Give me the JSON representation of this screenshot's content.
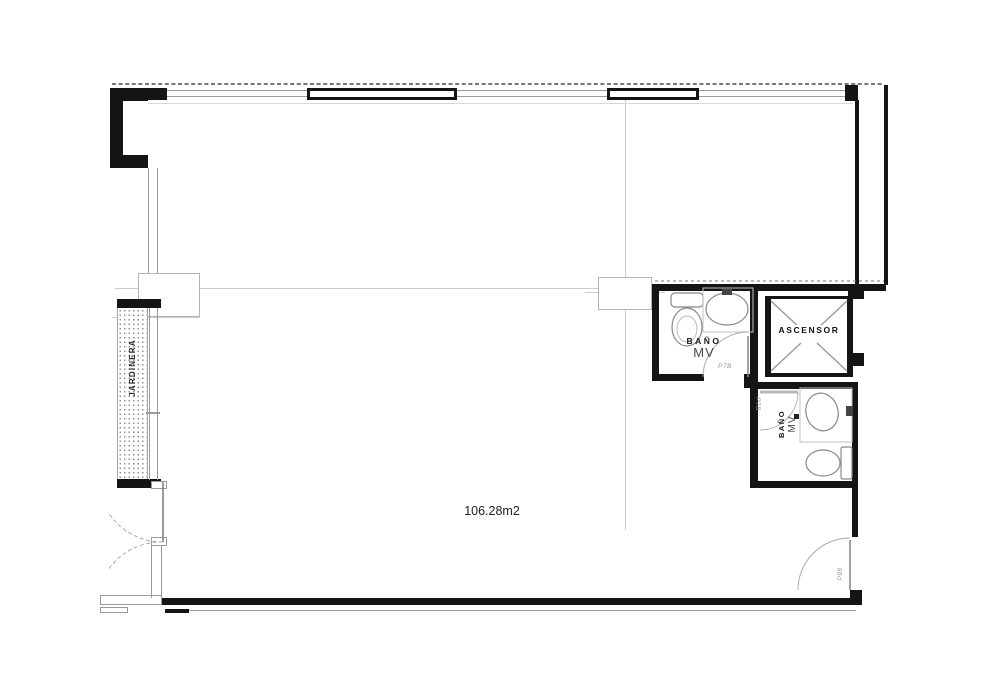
{
  "plan": {
    "area_label": "106.28m2",
    "elevator": {
      "label": "ASCENSOR"
    },
    "bathroom_main": {
      "label_line1": "BAÑO",
      "label_line2": "MV",
      "door_code": "P7B"
    },
    "bathroom_secondary": {
      "label_line1": "BAÑO",
      "label_line2": "MV",
      "door_code": "P7B"
    },
    "entry_door": {
      "code": "P98"
    },
    "planter": {
      "label": "JARDINERA"
    },
    "colors": {
      "wall": "#151515",
      "line": "#9a9a9a",
      "faint_line": "#cccccc",
      "text": "#222222",
      "code_text": "#969696"
    }
  }
}
